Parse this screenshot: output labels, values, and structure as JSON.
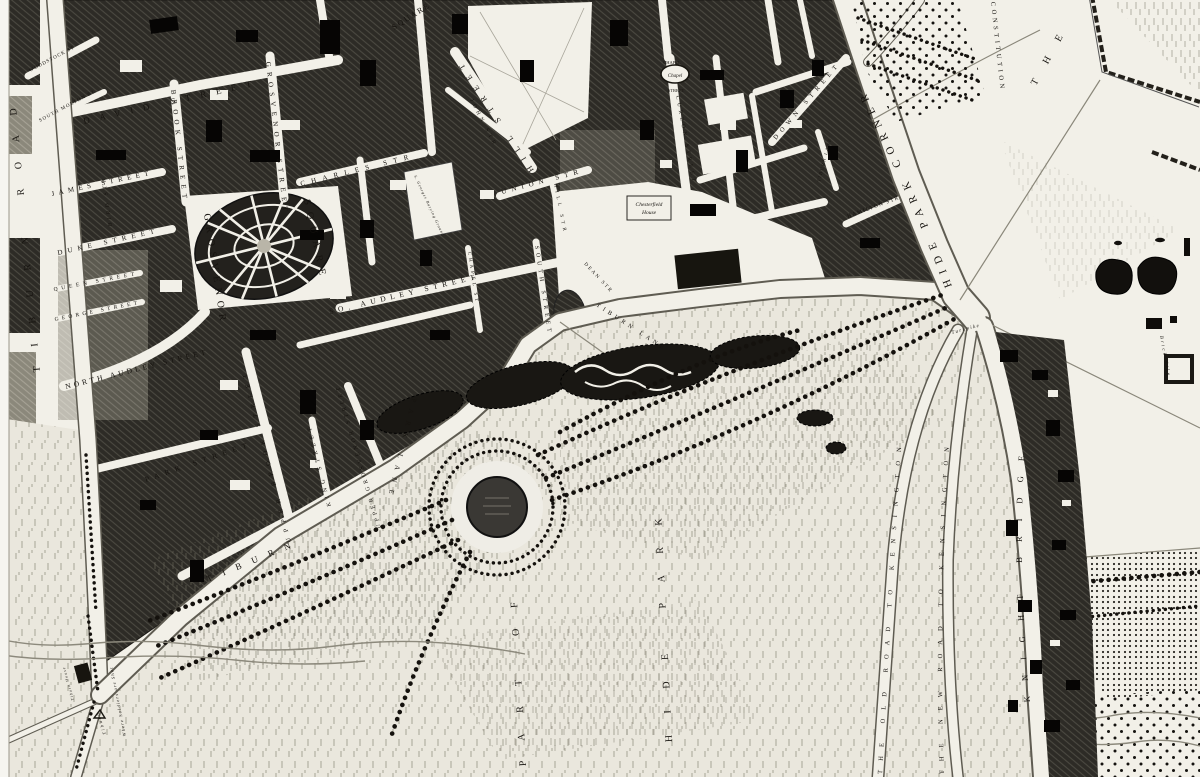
{
  "map": {
    "type": "historical-engraved-town-plan",
    "colors": {
      "paper": "#f2f0e8",
      "ink": "#171410",
      "block_hatch": "#2d2b26",
      "park_grass": "#eae7dd"
    },
    "labels": {
      "roads": {
        "tiburn_road": "TIBURN ROAD",
        "tiburn": "TIBURN",
        "tiburn_lane2": "TIBURN LANE",
        "park_lane": "PARK LANE",
        "hide_park_corner": "HIDE PARK CORNER",
        "old_kensington": "THE OLD ROAD TO KENSINGTON",
        "new_kensington": "THE NEW ROAD TO KENSINGTON",
        "knight_bridge": "KNIGHT BRIDGE",
        "constitution": "CONSTITUTION",
        "turnpike": "Turnpike"
      },
      "streets": {
        "woodstock": "WOODSTOCK ST",
        "south_molton": "SOUTH MOLTON ST",
        "david": "DAVID STREET",
        "james": "JAMES STREET",
        "bird": "BIRD STR",
        "duke": "DUKE STREET",
        "queen": "QUEEN STREET",
        "george": "GEORGE STREET",
        "north_audley": "NORTH AUDLEY STREET",
        "brook": "BROOK STREET",
        "grosvenor": "GROSVENOR STREET",
        "charles": "CHARLES STR",
        "park_street": "PARK STREET",
        "upper_brook": "UPPER BROOK STREET",
        "king": "KING STREET",
        "upper_grosvenor": "UPPER GROSVENOR STREET",
        "so_audley": "SO. AUDLEY STREET",
        "south": "SOUTH STREET",
        "chapel_w": "CHAPEL ST",
        "hill": "HILL STREET",
        "john": "JOHN STR",
        "union": "UNION STR",
        "hill_small": "HILL STR",
        "dean": "DEAN STR",
        "chapel_e_1": "CHAPEL",
        "chapel_e_2": "STREET",
        "curzon": "CURZON STREET",
        "down": "DOWN STREET",
        "tiburn_lane_small": "TIBURN LANE",
        "hamilton": "HAMILTON STR",
        "square_fragment": "SQUARE"
      },
      "places": {
        "grosvenor_square_1": "GROSVENOR",
        "grosvenor_square_2": "SQUARE",
        "chapel": "Chapel",
        "chesterfield_1": "Chesterfield",
        "chesterfield_2": "House",
        "burying_ground": "S. Georges Burying Ground",
        "the_park": "THE",
        "part_of": "PART OF",
        "hide_park": "HIDE PARK",
        "brick_kiln": "Brick Kiln",
        "soldiers": "Where Soldiers are Shot",
        "tiburn_house": "Tiburn House",
        "tiburn_gallows": "Tiburn"
      }
    }
  }
}
